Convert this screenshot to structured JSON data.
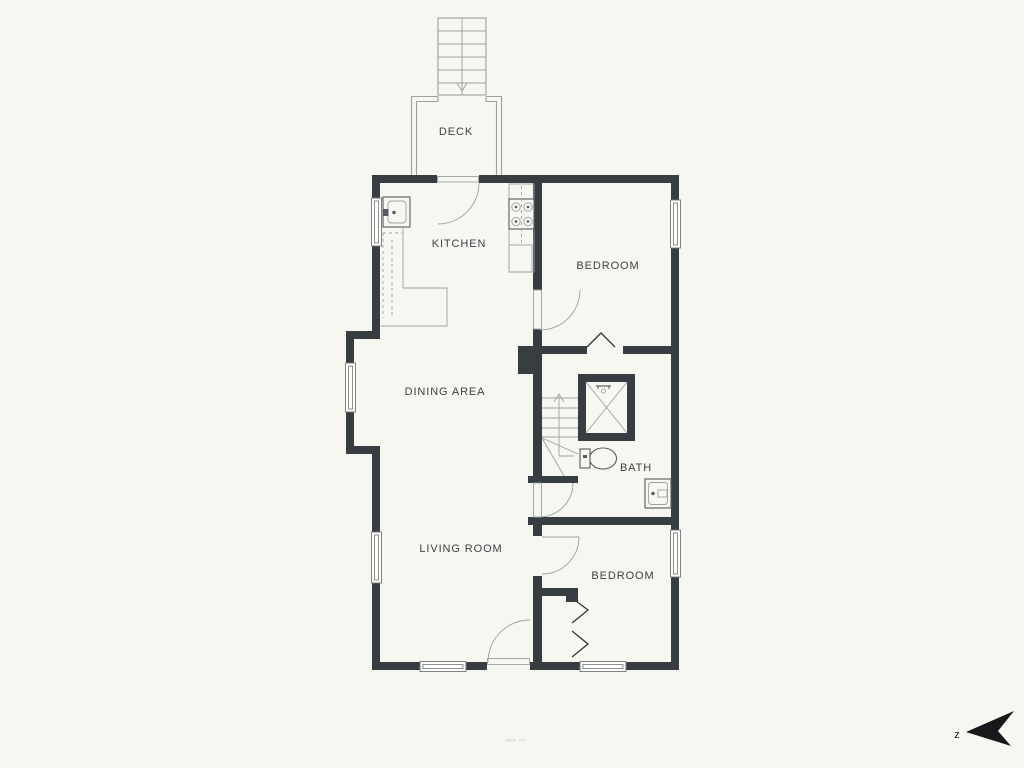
{
  "plan": {
    "rooms": {
      "deck": "DECK",
      "kitchen": "KITCHEN",
      "bedroom_top": "BEDROOM",
      "dining": "DINING AREA",
      "bath": "BATH",
      "living": "LIVING ROOM",
      "bedroom_bottom": "BEDROOM"
    },
    "compass": {
      "label": "z"
    },
    "colors": {
      "background": "#f7f7f1",
      "wall": "#383d41",
      "thin_line": "#9aa0a4",
      "fixture_line": "#565b5e",
      "text": "#3c4145",
      "north_arrow": "#17181a"
    }
  }
}
